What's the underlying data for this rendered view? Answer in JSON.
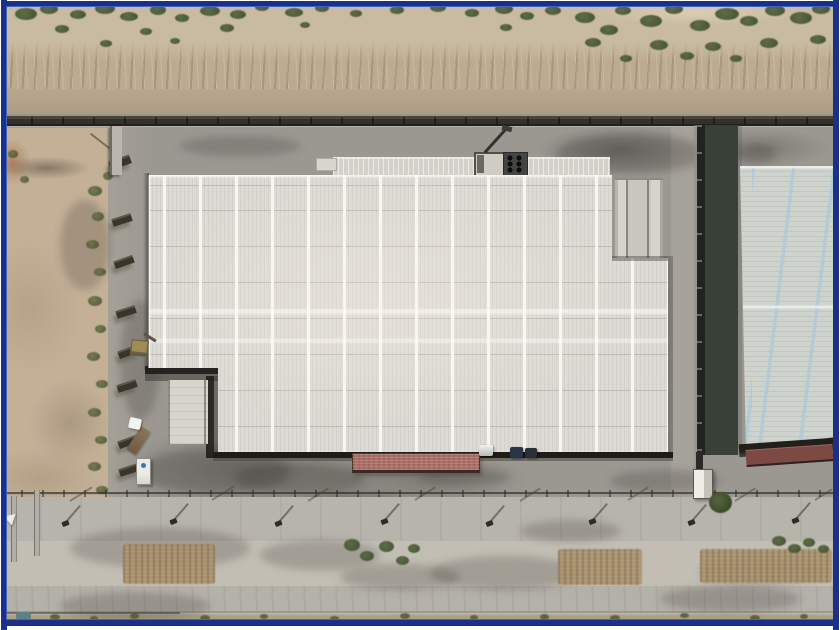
{
  "scene": {
    "type": "aerial-drone-photograph",
    "description": "Top-down aerial view of an industrial facility: a large warehouse with a white ribbed roof and skylight stripes at center, a second warehouse with pale-blue striped roof at right, desert scrubland and a dirt road above the perimeter wall, a bare dirt lot at left, and a street with lamp posts and dry median vegetation along the bottom. Dark navy picture frame border.",
    "objects": {
      "main_warehouse": "large warehouse, white ribbed roof with skylight stripes and L-shaped notch at lower-left",
      "right_warehouse": "neighboring warehouse with pale blue striped roof and shadowed side wall",
      "hvac_unit": "rooftop HVAC unit with six fans",
      "red_canopy": "red loading-dock canopy on south face",
      "right_red_canopy": "red canopy on right warehouse south face",
      "guard_booth": "white guard booth at facility gate",
      "portable_toilet": "portable toilet with blue vent",
      "truck": "white-cab truck with brown trailer",
      "excavator": "small excavator in yard notch",
      "cars": "three cars parked along south wall",
      "perimeter_wall": "dark perimeter wall across top",
      "street_lamps": "row of street lamps with shadows",
      "median_vegetation": "dry brown patches and green bushes in road median"
    }
  },
  "palette": {
    "border_navy": "#1b3186",
    "border_inner": "#3f63c6",
    "sand": "#c9bba2",
    "embank": "#bcab90",
    "veg_dark": "#3f5130",
    "veg_mid": "#55663c",
    "concrete": "#9b9892",
    "dirtlot": "#c3b097",
    "roof": "#dcdad4",
    "roof_stripe": "#f6f6f1",
    "canopy": "#d3d1c9",
    "ramp": "#d7d4cb",
    "red": "#aa7068",
    "red_right": "#7c4a42",
    "right_roof": "#ced3cd",
    "right_shadow": "#394038",
    "right_wall": "#21231f",
    "road": "#b7b4ac",
    "median": "#c2beb4",
    "roadlow": "#b4b1a9",
    "bottomstrip": "#aba189",
    "brown": "#a88f68",
    "lamp_dark": "#2e2c28",
    "car_blue": "#2b3547",
    "toilet_blue": "#2b79c8"
  },
  "scatter": {
    "top_bushes": {
      "parent": "#veg-top",
      "class": "bush",
      "name": "scrub-bush",
      "items": [
        [
          15,
          8,
          22,
          12
        ],
        [
          40,
          4,
          18,
          10
        ],
        [
          70,
          10,
          16,
          9
        ],
        [
          95,
          3,
          20,
          11
        ],
        [
          120,
          12,
          18,
          9
        ],
        [
          150,
          5,
          16,
          10
        ],
        [
          175,
          14,
          14,
          8
        ],
        [
          200,
          6,
          20,
          10
        ],
        [
          230,
          10,
          16,
          9
        ],
        [
          255,
          3,
          14,
          8
        ],
        [
          285,
          8,
          18,
          9
        ],
        [
          315,
          4,
          14,
          8
        ],
        [
          350,
          10,
          12,
          7
        ],
        [
          390,
          6,
          14,
          8
        ],
        [
          430,
          3,
          16,
          9
        ],
        [
          465,
          9,
          14,
          8
        ],
        [
          495,
          4,
          18,
          10
        ],
        [
          520,
          12,
          14,
          8
        ],
        [
          545,
          6,
          16,
          9
        ],
        [
          575,
          12,
          20,
          11
        ],
        [
          600,
          25,
          18,
          10
        ],
        [
          615,
          6,
          16,
          9
        ],
        [
          640,
          15,
          22,
          12
        ],
        [
          665,
          4,
          18,
          10
        ],
        [
          690,
          20,
          20,
          11
        ],
        [
          715,
          8,
          24,
          12
        ],
        [
          740,
          16,
          18,
          10
        ],
        [
          765,
          5,
          20,
          11
        ],
        [
          790,
          12,
          22,
          12
        ],
        [
          812,
          4,
          18,
          10
        ],
        [
          55,
          25,
          14,
          8
        ],
        [
          140,
          28,
          12,
          7
        ],
        [
          220,
          24,
          14,
          8
        ],
        [
          300,
          22,
          10,
          6
        ],
        [
          500,
          24,
          12,
          7
        ],
        [
          585,
          38,
          16,
          9
        ],
        [
          650,
          40,
          18,
          10
        ],
        [
          705,
          42,
          16,
          9
        ],
        [
          760,
          38,
          18,
          10
        ],
        [
          810,
          35,
          16,
          9
        ],
        [
          100,
          40,
          12,
          7
        ],
        [
          170,
          38,
          10,
          6
        ],
        [
          620,
          55,
          12,
          7
        ],
        [
          680,
          52,
          14,
          8
        ],
        [
          730,
          55,
          12,
          7
        ]
      ]
    },
    "left_vegetation": {
      "parent": "#veg-left",
      "class": "shrub",
      "name": "fence-shrub",
      "items": [
        [
          8,
          150,
          10,
          8
        ],
        [
          20,
          176,
          9,
          7
        ],
        [
          88,
          186,
          14,
          10
        ],
        [
          92,
          212,
          12,
          9
        ],
        [
          86,
          240,
          13,
          9
        ],
        [
          94,
          268,
          12,
          8
        ],
        [
          88,
          296,
          14,
          10
        ],
        [
          95,
          325,
          11,
          8
        ],
        [
          87,
          352,
          13,
          9
        ],
        [
          96,
          380,
          12,
          8
        ],
        [
          88,
          408,
          13,
          9
        ],
        [
          95,
          436,
          12,
          8
        ],
        [
          88,
          462,
          13,
          9
        ],
        [
          96,
          486,
          12,
          8
        ],
        [
          103,
          172,
          10,
          8
        ]
      ]
    },
    "fence_panels": {
      "parent": "#fence-left-panels",
      "class": "panel",
      "name": "fence-panel",
      "items": [
        [
          109,
          158,
          22,
          9,
          -20
        ],
        [
          112,
          216,
          20,
          8,
          -18
        ],
        [
          114,
          258,
          20,
          8,
          -20
        ],
        [
          116,
          308,
          20,
          8,
          -18
        ],
        [
          118,
          348,
          20,
          8,
          -20
        ],
        [
          117,
          382,
          20,
          8,
          -18
        ],
        [
          118,
          438,
          20,
          8,
          -20
        ],
        [
          119,
          466,
          20,
          8,
          -18
        ]
      ]
    },
    "yard_smudges": {
      "parent": "#smudges-yard",
      "class": "smudge",
      "name": "ground-smudge",
      "items": [
        [
          140,
          448,
          150,
          46
        ],
        [
          235,
          464,
          130,
          30
        ],
        [
          300,
          492,
          100,
          22
        ],
        [
          420,
          468,
          90,
          18
        ],
        [
          610,
          470,
          110,
          22
        ],
        [
          556,
          134,
          150,
          40
        ],
        [
          736,
          144,
          40,
          20
        ],
        [
          180,
          136,
          120,
          20
        ],
        [
          120,
          300,
          40,
          120
        ],
        [
          60,
          200,
          50,
          90
        ]
      ]
    },
    "road_smudges": {
      "parent": "#smudges-road",
      "class": "smudge",
      "name": "road-smudge",
      "items": [
        [
          70,
          528,
          180,
          40
        ],
        [
          260,
          540,
          120,
          30
        ],
        [
          430,
          556,
          150,
          34
        ],
        [
          340,
          564,
          120,
          26
        ],
        [
          660,
          586,
          140,
          26
        ],
        [
          60,
          592,
          150,
          28
        ],
        [
          520,
          520,
          100,
          22
        ],
        [
          700,
          560,
          120,
          24
        ]
      ]
    },
    "brown_patches": {
      "parent": "#median-veg",
      "class": "brown",
      "name": "dry-vegetation-patch",
      "items": [
        [
          123,
          544,
          92,
          40
        ],
        [
          558,
          549,
          84,
          36
        ],
        [
          700,
          549,
          132,
          34
        ]
      ]
    },
    "median_bushes": {
      "parent": "#median-veg",
      "class": "bush",
      "name": "median-bush",
      "items": [
        [
          344,
          539,
          16,
          12
        ],
        [
          360,
          551,
          14,
          10
        ],
        [
          379,
          541,
          15,
          11
        ],
        [
          396,
          556,
          13,
          9
        ],
        [
          408,
          544,
          12,
          9
        ],
        [
          772,
          536,
          14,
          10
        ],
        [
          788,
          544,
          13,
          9
        ],
        [
          803,
          538,
          12,
          9
        ],
        [
          818,
          545,
          11,
          8
        ]
      ]
    },
    "street_lamps": {
      "parent": "#lamp-row",
      "class": "lamp",
      "name": "street-lamp",
      "items": [
        [
          62,
          521
        ],
        [
          170,
          519
        ],
        [
          275,
          521
        ],
        [
          381,
          519
        ],
        [
          486,
          521
        ],
        [
          589,
          519
        ],
        [
          688,
          520
        ],
        [
          792,
          518
        ]
      ]
    },
    "rail_shadows": {
      "parent": "#rail-shadows",
      "class": "dash",
      "name": "fence-shadow-line",
      "items": [
        [
          70,
          500,
          26,
          2,
          -32
        ],
        [
          212,
          499,
          26,
          2,
          -32
        ],
        [
          308,
          500,
          24,
          2,
          -32
        ],
        [
          415,
          499,
          24,
          2,
          -32
        ],
        [
          520,
          500,
          24,
          2,
          -32
        ],
        [
          628,
          499,
          24,
          2,
          -32
        ],
        [
          735,
          500,
          24,
          2,
          -32
        ],
        [
          815,
          499,
          20,
          2,
          -32
        ]
      ]
    },
    "bottom_vegetation": {
      "parent": "#bottom-veg",
      "class": "sprig",
      "name": "roadside-sprig",
      "items": [
        [
          50,
          614,
          10,
          6
        ],
        [
          90,
          616,
          8,
          5
        ],
        [
          130,
          613,
          9,
          6
        ],
        [
          200,
          615,
          10,
          6
        ],
        [
          260,
          614,
          8,
          5
        ],
        [
          330,
          616,
          9,
          5
        ],
        [
          400,
          613,
          10,
          6
        ],
        [
          470,
          615,
          8,
          5
        ],
        [
          540,
          614,
          9,
          6
        ],
        [
          610,
          615,
          10,
          6
        ],
        [
          680,
          613,
          9,
          5
        ],
        [
          750,
          615,
          10,
          6
        ],
        [
          800,
          614,
          8,
          5
        ]
      ]
    }
  }
}
